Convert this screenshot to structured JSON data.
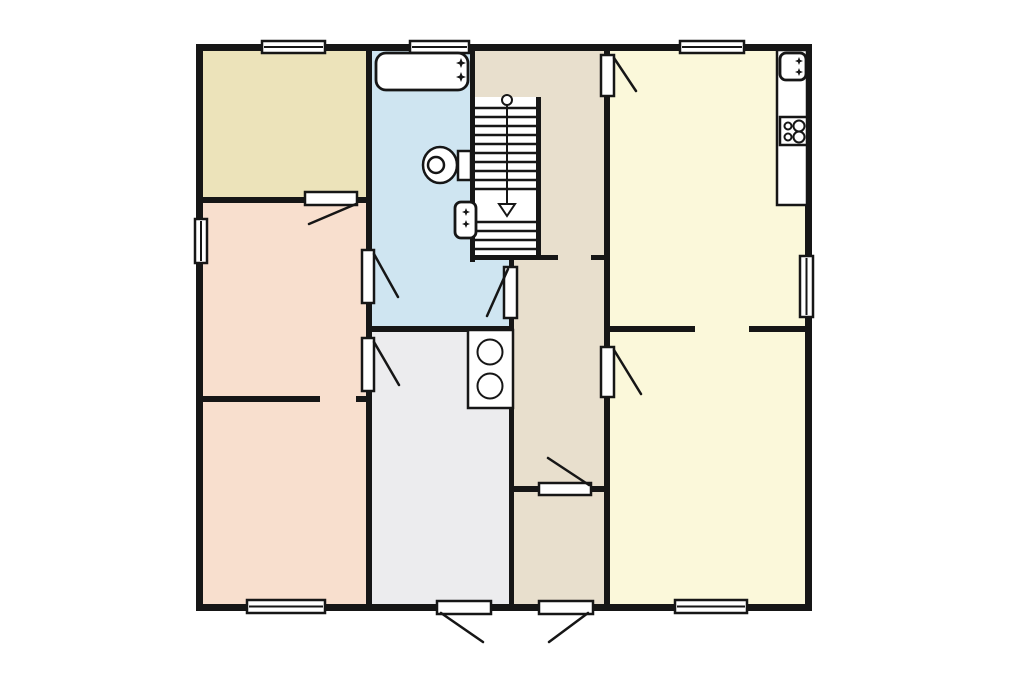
{
  "floor_plan": {
    "canvas": {
      "width": 1024,
      "height": 680,
      "background": "#ffffff"
    },
    "colors": {
      "wall": "#161616",
      "beige": "#ece3ba",
      "pink": "#f8dfce",
      "blue": "#cfe5f1",
      "tan": "#e8dfcd",
      "yellow": "#fbf8da",
      "gray": "#ececee",
      "white": "#ffffff"
    },
    "rooms": [
      {
        "name": "room-top-left",
        "color": "beige",
        "rect": [
          199,
          47,
          170,
          150
        ]
      },
      {
        "name": "room-mid-left",
        "color": "pink",
        "rect": [
          199,
          197,
          170,
          203
        ]
      },
      {
        "name": "room-bottom-left",
        "color": "pink",
        "rect": [
          199,
          398,
          170,
          209
        ]
      },
      {
        "name": "bathroom",
        "color": "blue",
        "rect": [
          369,
          47,
          104,
          283
        ]
      },
      {
        "name": "bathroom-lower",
        "color": "blue",
        "rect": [
          473,
          258,
          39,
          72
        ]
      },
      {
        "name": "landing-top",
        "color": "tan",
        "rect": [
          473,
          47,
          133,
          50
        ]
      },
      {
        "name": "hall-beside-stairs",
        "color": "tan",
        "rect": [
          539,
          97,
          67,
          161
        ]
      },
      {
        "name": "hallway",
        "color": "tan",
        "rect": [
          512,
          258,
          94,
          231
        ]
      },
      {
        "name": "vestibule",
        "color": "tan",
        "rect": [
          512,
          489,
          94,
          118
        ]
      },
      {
        "name": "kitchen",
        "color": "yellow",
        "rect": [
          606,
          47,
          202,
          281
        ]
      },
      {
        "name": "room-bottom-right",
        "color": "yellow",
        "rect": [
          606,
          328,
          202,
          279
        ]
      },
      {
        "name": "utility-room",
        "color": "gray",
        "rect": [
          369,
          330,
          142,
          277
        ]
      },
      {
        "name": "stairwell",
        "color": "white",
        "rect": [
          473,
          97,
          65,
          161
        ]
      }
    ],
    "walls": [
      {
        "name": "wall-exterior-top",
        "rect": [
          196,
          44,
          616,
          7
        ]
      },
      {
        "name": "wall-exterior-bottom",
        "rect": [
          196,
          604,
          616,
          7
        ]
      },
      {
        "name": "wall-exterior-left",
        "rect": [
          196,
          44,
          7,
          567
        ]
      },
      {
        "name": "wall-exterior-right",
        "rect": [
          805,
          44,
          7,
          567
        ]
      },
      {
        "name": "wall-left-rooms-east",
        "rect": [
          366,
          47,
          6,
          560
        ]
      },
      {
        "name": "wall-beige-pink-divider",
        "rect": [
          201,
          197,
          166,
          6
        ]
      },
      {
        "name": "wall-pink-divider",
        "rect": [
          201,
          396,
          119,
          6
        ]
      },
      {
        "name": "wall-pink-divider-stub",
        "rect": [
          356,
          396,
          11,
          6
        ]
      },
      {
        "name": "wall-bathroom-stairs",
        "rect": [
          470,
          50,
          5,
          212
        ]
      },
      {
        "name": "wall-stairs-east",
        "rect": [
          536,
          97,
          5,
          163
        ]
      },
      {
        "name": "wall-stairs-foot",
        "rect": [
          470,
          255,
          88,
          5
        ]
      },
      {
        "name": "wall-stairs-foot-stub",
        "rect": [
          591,
          255,
          16,
          5
        ]
      },
      {
        "name": "wall-hall-west",
        "rect": [
          509,
          258,
          5,
          349
        ]
      },
      {
        "name": "wall-bathroom-south",
        "rect": [
          366,
          326,
          147,
          6
        ]
      },
      {
        "name": "wall-center-east",
        "rect": [
          604,
          47,
          6,
          560
        ]
      },
      {
        "name": "wall-right-divider-west",
        "rect": [
          604,
          326,
          91,
          6
        ]
      },
      {
        "name": "wall-right-divider-east",
        "rect": [
          749,
          326,
          58,
          6
        ]
      },
      {
        "name": "wall-vestibule-north",
        "rect": [
          512,
          486,
          94,
          6
        ]
      }
    ],
    "windows": [
      {
        "name": "window-top-left-room",
        "rect": [
          262,
          41,
          63,
          12
        ]
      },
      {
        "name": "window-bathroom",
        "rect": [
          410,
          41,
          59,
          12
        ]
      },
      {
        "name": "window-kitchen",
        "rect": [
          680,
          41,
          64,
          12
        ]
      },
      {
        "name": "window-left",
        "rect": [
          195,
          219,
          12,
          44
        ]
      },
      {
        "name": "window-right",
        "rect": [
          800,
          256,
          13,
          61
        ]
      },
      {
        "name": "window-bottom-left",
        "rect": [
          247,
          600,
          78,
          13
        ]
      },
      {
        "name": "window-bottom-right",
        "rect": [
          675,
          600,
          72,
          13
        ]
      }
    ],
    "doors": [
      {
        "name": "door-top-left-room",
        "leaf": [
          305,
          192,
          52,
          13
        ],
        "swing": [
          356,
          204,
          309,
          224
        ]
      },
      {
        "name": "door-bathroom-west",
        "leaf": [
          362,
          250,
          12,
          53
        ],
        "swing": [
          374,
          254,
          398,
          297
        ]
      },
      {
        "name": "door-utility-west",
        "leaf": [
          362,
          338,
          12,
          53
        ],
        "swing": [
          374,
          342,
          399,
          385
        ]
      },
      {
        "name": "door-bathroom-hall",
        "leaf": [
          504,
          267,
          13,
          51
        ],
        "swing": [
          508,
          269,
          487,
          316
        ]
      },
      {
        "name": "door-kitchen",
        "leaf": [
          601,
          55,
          13,
          41
        ],
        "swing": [
          614,
          58,
          636,
          91
        ]
      },
      {
        "name": "door-bottom-right-room",
        "leaf": [
          601,
          347,
          13,
          50
        ],
        "swing": [
          614,
          350,
          641,
          394
        ]
      },
      {
        "name": "door-vestibule",
        "leaf": [
          539,
          483,
          52,
          12
        ],
        "swing": [
          589,
          485,
          548,
          458
        ]
      },
      {
        "name": "door-front",
        "leaf": [
          539,
          601,
          54,
          13
        ],
        "swing": [
          588,
          613,
          549,
          642
        ]
      },
      {
        "name": "door-utility-exterior",
        "leaf": [
          437,
          601,
          54,
          13
        ],
        "swing": [
          441,
          613,
          483,
          642
        ]
      }
    ],
    "stairs": {
      "name": "staircase",
      "tread_x": [
        475,
        536
      ],
      "treads_y": [
        108,
        117,
        126,
        135,
        144,
        153,
        162,
        171,
        180,
        189,
        222,
        231,
        240,
        249
      ],
      "direction_line": [
        507,
        105,
        507,
        204
      ],
      "start_circle": [
        507,
        100,
        5
      ],
      "arrow": [
        [
          499,
          204
        ],
        [
          515,
          204
        ],
        [
          507,
          216
        ]
      ]
    },
    "fixtures": [
      {
        "name": "bathtub",
        "type": "rounded-rect",
        "rect": [
          376,
          53,
          92,
          37
        ],
        "radius": 10
      },
      {
        "name": "bathtub-taps-icon",
        "type": "stars",
        "points": [
          [
            461,
            63
          ],
          [
            461,
            77
          ]
        ],
        "size": 5
      },
      {
        "name": "toilet-cistern",
        "type": "rect",
        "rect": [
          458,
          151,
          13,
          29
        ]
      },
      {
        "name": "toilet-bowl",
        "type": "ellipse",
        "center": [
          440,
          165
        ],
        "rx": 17,
        "ry": 18
      },
      {
        "name": "toilet-seat",
        "type": "circle",
        "center": [
          436,
          165
        ],
        "r": 8
      },
      {
        "name": "basin",
        "type": "rounded-rect",
        "rect": [
          455,
          202,
          21,
          36
        ],
        "radius": 6
      },
      {
        "name": "basin-taps-icon",
        "type": "stars",
        "points": [
          [
            466,
            212
          ],
          [
            466,
            224
          ]
        ],
        "size": 4
      },
      {
        "name": "kitchen-counter",
        "type": "rect",
        "rect": [
          777,
          50,
          30,
          155
        ]
      },
      {
        "name": "kitchen-sink",
        "type": "rounded-rect",
        "rect": [
          780,
          53,
          26,
          27
        ],
        "radius": 6
      },
      {
        "name": "kitchen-sink-taps-icon",
        "type": "stars",
        "points": [
          [
            799,
            61
          ],
          [
            799,
            72
          ]
        ],
        "size": 4
      },
      {
        "name": "hob",
        "type": "rect",
        "rect": [
          780,
          117,
          27,
          28
        ]
      },
      {
        "name": "hob-burners-icon",
        "type": "circles",
        "circles": [
          [
            788,
            126,
            3.5
          ],
          [
            799,
            126,
            5.5
          ],
          [
            788,
            137,
            3.5
          ],
          [
            799,
            137,
            5.5
          ]
        ]
      },
      {
        "name": "utility-appliance",
        "type": "rect",
        "rect": [
          468,
          330,
          45,
          78
        ]
      },
      {
        "name": "utility-appliance-drums-icon",
        "type": "circles",
        "circles": [
          [
            490,
            352,
            12.5
          ],
          [
            490,
            386,
            12.5
          ]
        ]
      }
    ]
  }
}
